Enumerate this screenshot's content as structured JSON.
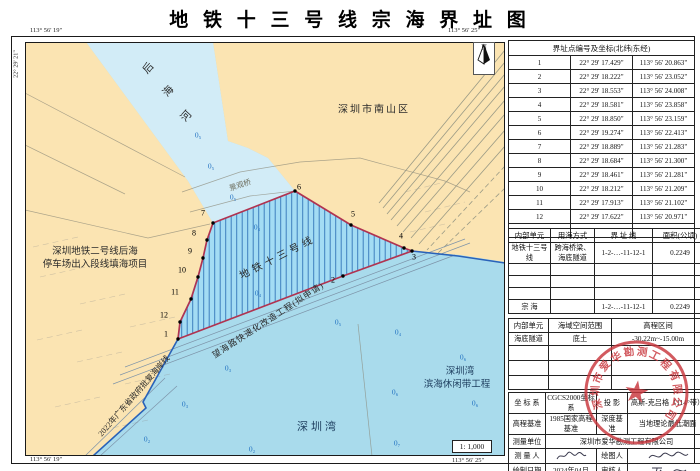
{
  "title": "地 铁 十 三 号 线 宗 海 界 址 图",
  "map": {
    "coords": {
      "top_left": "113° 56' 19\"",
      "top_right": "113° 56' 25\"",
      "bottom_left": "113° 56' 19\"",
      "bottom_right": "113° 56' 25\"",
      "left_top": "22° 29' 21\"",
      "right_top": "22° 29' 21\"",
      "right_bottom": "22° 29' 16\""
    },
    "north_label": "N",
    "scale": "1: 1,000",
    "labels": {
      "river_char_1": "后",
      "river_char_2": "海",
      "river_char_3": "河",
      "district": "深圳市南山区",
      "bridge": "景观桥",
      "project_left_line1": "深圳地铁二号线后海",
      "project_left_line2": "停车场出入段线填海项目",
      "parcel": "地铁十三号线",
      "road": "望海路快速化改造工程(拟申请)",
      "coastline": "2022年广东省政府批复海岸线",
      "bay": "深圳湾",
      "bay_project_line1": "深圳湾",
      "bay_project_line2": "滨海休闲带工程"
    },
    "points": [
      {
        "n": "1"
      },
      {
        "n": "2"
      },
      {
        "n": "3"
      },
      {
        "n": "4"
      },
      {
        "n": "5"
      },
      {
        "n": "6"
      },
      {
        "n": "7"
      },
      {
        "n": "8"
      },
      {
        "n": "9"
      },
      {
        "n": "10"
      },
      {
        "n": "11"
      },
      {
        "n": "12"
      }
    ],
    "depth_marks": [
      {
        "t": "0₅"
      },
      {
        "t": "0₅"
      },
      {
        "t": "0₅"
      },
      {
        "t": "0₄"
      },
      {
        "t": "0₄"
      },
      {
        "t": "0₅"
      },
      {
        "t": "0₄"
      },
      {
        "t": "0₆"
      },
      {
        "t": "0₆"
      },
      {
        "t": "0₆"
      },
      {
        "t": "0₇"
      },
      {
        "t": "0₃"
      },
      {
        "t": "0₃"
      },
      {
        "t": "0₂"
      },
      {
        "t": "0₂"
      }
    ]
  },
  "tables": {
    "boundary": {
      "header": "界址点编号及坐标(北纬|东经)",
      "rows": [
        {
          "id": "1",
          "lat": "22° 29' 17.429\"",
          "lon": "113° 56' 20.863\""
        },
        {
          "id": "2",
          "lat": "22° 29' 18.222\"",
          "lon": "113° 56' 23.052\""
        },
        {
          "id": "3",
          "lat": "22° 29' 18.553\"",
          "lon": "113° 56' 24.008\""
        },
        {
          "id": "4",
          "lat": "22° 29' 18.581\"",
          "lon": "113° 56' 23.858\""
        },
        {
          "id": "5",
          "lat": "22° 29' 18.850\"",
          "lon": "113° 56' 23.159\""
        },
        {
          "id": "6",
          "lat": "22° 29' 19.274\"",
          "lon": "113° 56' 22.413\""
        },
        {
          "id": "7",
          "lat": "22° 29' 18.889\"",
          "lon": "113° 56' 21.283\""
        },
        {
          "id": "8",
          "lat": "22° 29' 18.684\"",
          "lon": "113° 56' 21.300\""
        },
        {
          "id": "9",
          "lat": "22° 29' 18.461\"",
          "lon": "113° 56' 21.281\""
        },
        {
          "id": "10",
          "lat": "22° 29' 18.212\"",
          "lon": "113° 56' 21.209\""
        },
        {
          "id": "11",
          "lat": "22° 29' 17.913\"",
          "lon": "113° 56' 21.102\""
        },
        {
          "id": "12",
          "lat": "22° 29' 17.622\"",
          "lon": "113° 56' 20.971\""
        }
      ]
    },
    "usage": {
      "headers": [
        "内部单元",
        "用海方式",
        "界 址 线",
        "面积(公顷)"
      ],
      "rows": [
        {
          "unit": "地铁十三号线",
          "mode": "跨海桥梁、海底隧道",
          "line": "1-2-…-11-12-1",
          "area": "0.2249"
        },
        {
          "unit": "宗  海",
          "mode": "",
          "line": "1-2-…-11-12-1",
          "area": "0.2249"
        }
      ]
    },
    "space": {
      "headers": [
        "内部单元",
        "海域空间范围",
        "高程区间"
      ],
      "rows": [
        {
          "unit": "海底隧道",
          "range": "底土",
          "elev": "-30.22m~-15.00m"
        }
      ]
    },
    "meta": {
      "rows": [
        {
          "k1": "坐 标 系",
          "v1": "CGCS2000坐标系",
          "k2": "投  影",
          "v2": "高斯-克吕格（114°带）"
        },
        {
          "k1": "高程基准",
          "v1": "1985国家高程基准",
          "k2": "深度基准",
          "v2": "当地理论最低潮面"
        },
        {
          "k1": "测量单位",
          "v1": "深圳市爱华勘测工程有限公司"
        },
        {
          "k1": "测 量 人",
          "k2": "绘图人"
        },
        {
          "k1": "绘制日期",
          "v1": "2024年04月",
          "k2": "审核人"
        }
      ]
    }
  },
  "seal": {
    "text": "深圳市爱华勘测工程有限公司",
    "color": "#c9363d"
  },
  "colors": {
    "land": "#fbe4b2",
    "river": "#d2ecf7",
    "bay": "#a9dbec",
    "parcel_fill": "#a3dcf4",
    "parcel_hatch": "#3e7fbe",
    "parcel_border": "#b03350",
    "coastline": "#2a62b8",
    "depth_text": "#1f6fc0",
    "seal_red": "#c9363d"
  }
}
